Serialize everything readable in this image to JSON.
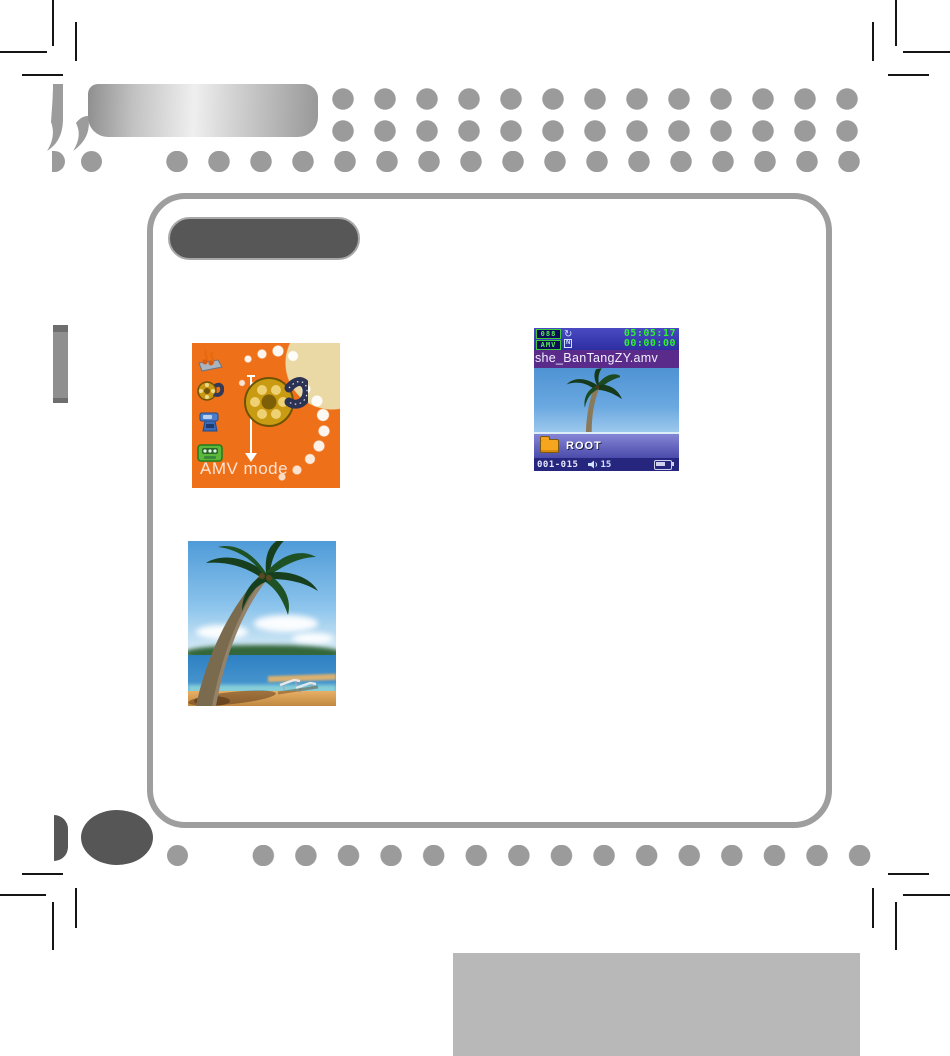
{
  "document": {
    "kind": "mp4-player-manual-page"
  },
  "menu_screen": {
    "label": "AMV mode",
    "icons": [
      {
        "name": "music-mode-icon"
      },
      {
        "name": "movie-mode-icon"
      },
      {
        "name": "record-mode-icon"
      },
      {
        "name": "game-mode-icon"
      }
    ],
    "colors": {
      "background": "#ee7018",
      "label": "#ffe3d6"
    }
  },
  "player_screen": {
    "status": {
      "track_number": "088",
      "format_badge": "AMV",
      "repeat_glyph": "↻",
      "play_state": "N",
      "time_total": "05:05:17",
      "time_elapsed": "00:00:00"
    },
    "filename": "she_BanTangZY.amv",
    "folder_label": "ROOT",
    "counter": "001-015",
    "volume": "15",
    "colors": {
      "status_bar": "#3c3cb2",
      "filename_bar": "#5a2b8a",
      "lcd_green": "#2ef22e",
      "folder_bar": "#5d5dbd",
      "bottom_bar": "#26267e"
    }
  },
  "decor": {
    "dot_color": "#9b9b9b",
    "dark_shape_color": "#565656",
    "frame_border_color": "#9e9e9e",
    "footer_block_color": "#b8b8b8"
  }
}
